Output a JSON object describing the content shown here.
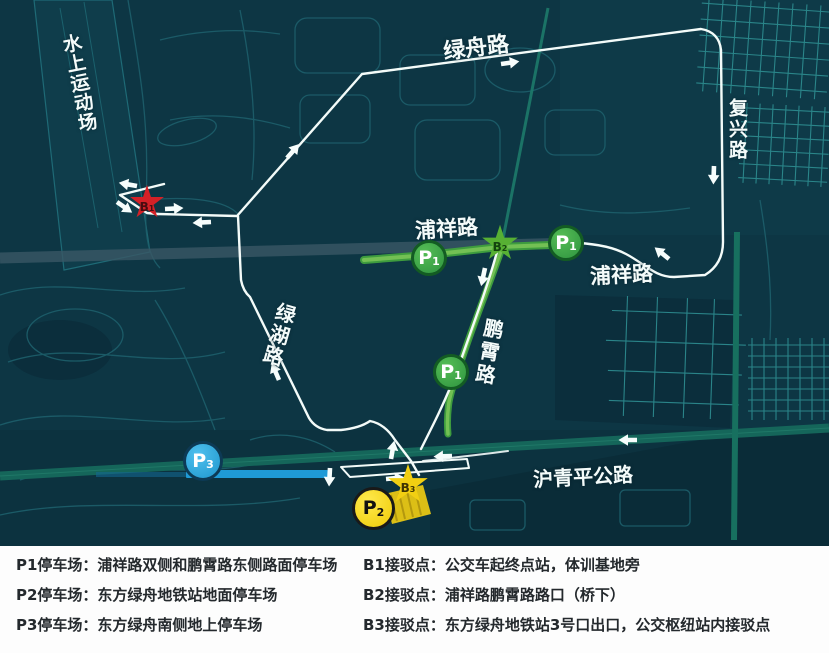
{
  "map": {
    "road_labels": {
      "water_sports": "水上运动场",
      "luzhou_road": "绿舟路",
      "fuxing_road": "复兴路",
      "puxiang_road_west": "浦祥路",
      "puxiang_road_east": "浦祥路",
      "pengxiao_road": "鹏霄路",
      "luhu_road": "绿湖路",
      "huqingping_highway": "沪青平公路"
    },
    "markers": {
      "p1": {
        "letter": "P",
        "sub": "1"
      },
      "p2": {
        "letter": "P",
        "sub": "2"
      },
      "p3": {
        "letter": "P",
        "sub": "3"
      },
      "b1": {
        "letter": "B",
        "sub": "1"
      },
      "b2": {
        "letter": "B",
        "sub": "2"
      },
      "b3": {
        "letter": "B",
        "sub": "3"
      }
    },
    "colors": {
      "map_background": "#0d3644",
      "route_white": "#f3fbf9",
      "parking_road_green": "#4aa746",
      "p1_green": "#3fa040",
      "p2_yellow": "#f4d312",
      "p3_blue": "#2aa5dc",
      "b1_red": "#d42127",
      "b2_green": "#57b033",
      "b3_yellow": "#f2cf12"
    }
  },
  "legend": {
    "left": [
      "P1停车场：浦祥路双侧和鹏霄路东侧路面停车场",
      "P2停车场：东方绿舟地铁站地面停车场",
      "P3停车场：东方绿舟南侧地上停车场"
    ],
    "right": [
      "B1接驳点：公交车起终点站，体训基地旁",
      "B2接驳点：浦祥路鹏霄路路口（桥下）",
      "B3接驳点：东方绿舟地铁站3号口出口，公交枢纽站内接驳点"
    ]
  }
}
